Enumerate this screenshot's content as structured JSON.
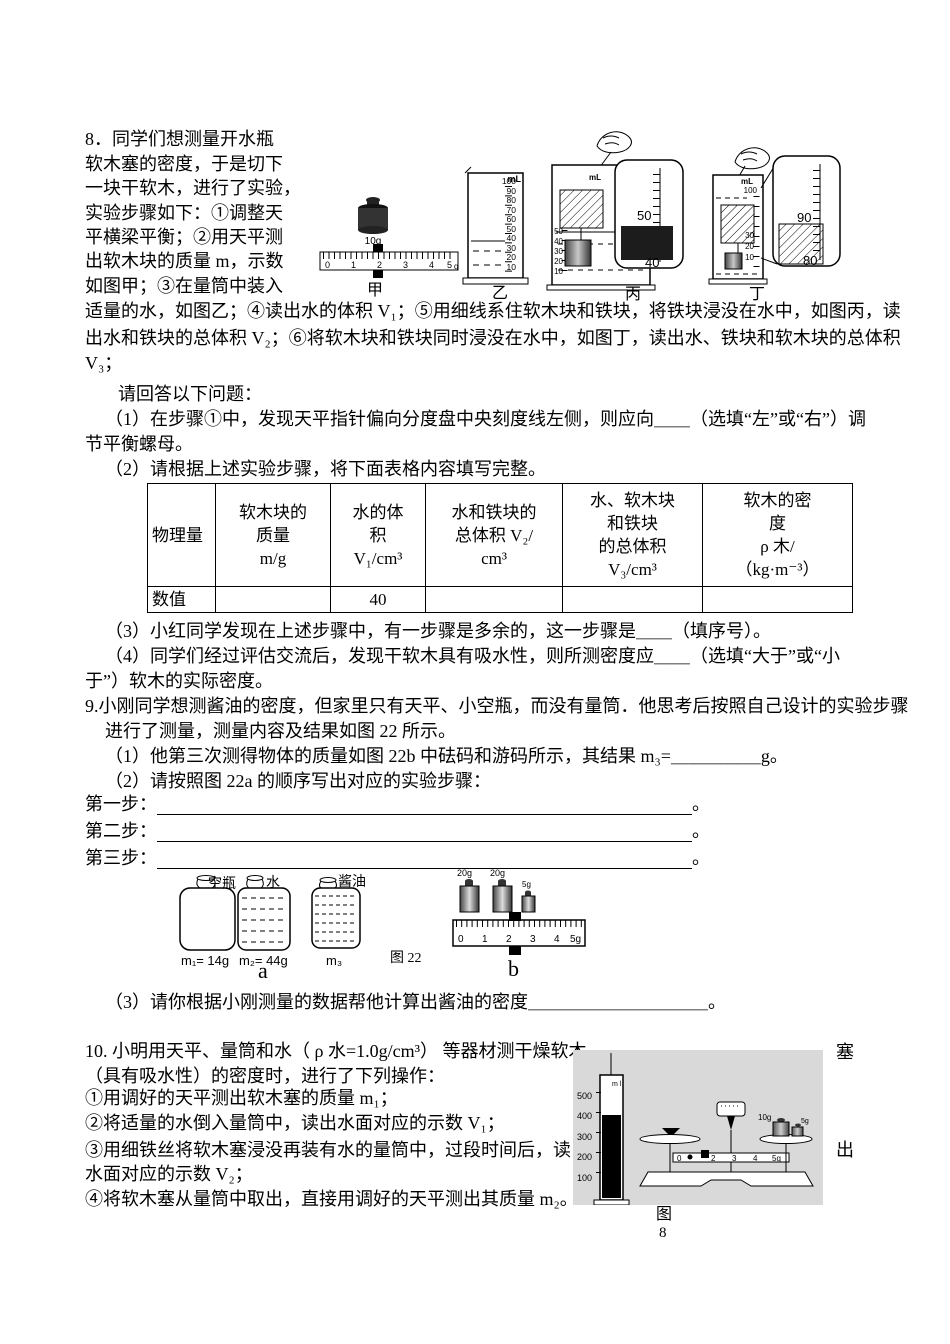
{
  "q8": {
    "intro_lines": [
      "8．同学们想测量开水瓶",
      "软木塞的密度，于是切下",
      "一块干软木，进行了实验，",
      "实验步骤如下：①调整天",
      "平横梁平衡；②用天平测",
      "出软木块的质量 m，示数",
      "如图甲；③在量筒中装入"
    ],
    "full_lines": [
      "适量的水，如图乙；④读出水的体积 V₁；⑤用细线系住软木块和铁块，将铁块浸没在水中，如图丙，读",
      "出水和铁块的总体积 V₂；⑥将软木块和铁块同时浸没在水中，如图丁，读出水、铁块和软木块的总体积",
      "V₃；"
    ],
    "prompt": "请回答以下问题：",
    "q1_line1": "（1）在步骤①中，发现天平指针偏向分度盘中央刻度线左侧，则应向＿＿（选填“左”或“右”）调",
    "q1_line2": "节平衡螺母。",
    "q2": "（2）请根据上述实验步骤，将下面表格内容填写完整。",
    "q3": "（3）小红同学发现在上述步骤中，有一步骤是多余的，这一步骤是＿＿（填序号）。",
    "q4_line1": "（4）同学们经过评估交流后，发现干软木具有吸水性，则所测密度应＿＿（选填“大于”或“小",
    "q4_line2": "于”）软木的实际密度。",
    "table": {
      "headers": [
        "物理量",
        "软木块的\n质量\nm/g",
        "水的体\n积\nV₁/cm³",
        "水和铁块的\n总体积 V₂/\ncm³",
        "水、软木块\n和铁块\n的总体积\nV₃/cm³",
        "软木的密\n度\nρ 木/\n（kg·m⁻³）"
      ],
      "row_label": "数值",
      "values": [
        "",
        "40",
        "",
        "",
        ""
      ]
    },
    "figure": {
      "jia": {
        "weight": "10g",
        "ticks": [
          "0",
          "1",
          "2",
          "3",
          "4",
          "5"
        ],
        "unit": "g",
        "label": "甲"
      },
      "yi": {
        "unit": "mL",
        "scale": "100\n90\n80\n70\n60\n50\n40\n30\n20\n10",
        "label": "乙"
      },
      "bing": {
        "unit": "mL",
        "scale": "50\n40\n30\n20\n10",
        "inset_top": "50",
        "inset_bottom": "40",
        "label": "丙"
      },
      "ding": {
        "unit": "mL",
        "top": "100",
        "scale": "30\n20\n10",
        "inset_top": "90",
        "inset_bottom": "80",
        "label": "丁"
      }
    }
  },
  "q9": {
    "line1": "9.小刚同学想测酱油的密度，但家里只有天平、小空瓶，而没有量筒．他思考后按照自己设计的实验步骤",
    "line2": "进行了测量，测量内容及结果如图 22 所示。",
    "q1": "（1）他第三次测得物体的质量如图 22b 中砝码和游码所示，其结果 m₃=＿＿＿＿＿g。",
    "q2": "（2）请按照图 22a 的顺序写出对应的实验步骤：",
    "steps": [
      "第一步：",
      "第二步：",
      "第三步："
    ],
    "period": "。",
    "q3": "（3）请你根据小刚测量的数据帮他计算出酱油的密度＿＿＿＿＿＿＿＿＿＿。",
    "figure": {
      "bottles": [
        {
          "label": "空瓶",
          "mass": "m₁= 14g"
        },
        {
          "label": "水",
          "mass": "m₂= 44g"
        },
        {
          "label": "酱油",
          "mass": "m₃"
        }
      ],
      "sub_a": "a",
      "caption": "图 22",
      "weights": [
        "20g",
        "20g",
        "5g"
      ],
      "ruler_ticks": [
        "0",
        "1",
        "2",
        "3",
        "4"
      ],
      "ruler_end": "5g",
      "sub_b": "b"
    }
  },
  "q10": {
    "line1": "10. 小明用天平、量筒和水（ ρ 水=1.0g/cm³） 等器材测干燥软木",
    "line2": "（具有吸水性）的密度时，进行了下列操作：",
    "step1": "①用调好的天平测出软木塞的质量 m₁；",
    "step2": "②将适量的水倒入量筒中，读出水面对应的示数 V₁；",
    "step3": "③用细铁丝将软木塞浸没再装有水的量筒中，过段时间后，读",
    "step3b": "水面对应的示数 V₂；",
    "step4": "④将软木塞从量筒中取出，直接用调好的天平测出其质量 m₂。",
    "float_right_1": "塞",
    "float_right_2": "出",
    "figure": {
      "unit": "m l",
      "scale": "500\n400\n300\n200\n100",
      "weight_labels": [
        "10g",
        "5g"
      ],
      "beam": [
        "0",
        "2",
        "3",
        "4",
        "5g"
      ],
      "caption_line1": "图",
      "caption_line2": "8"
    }
  }
}
